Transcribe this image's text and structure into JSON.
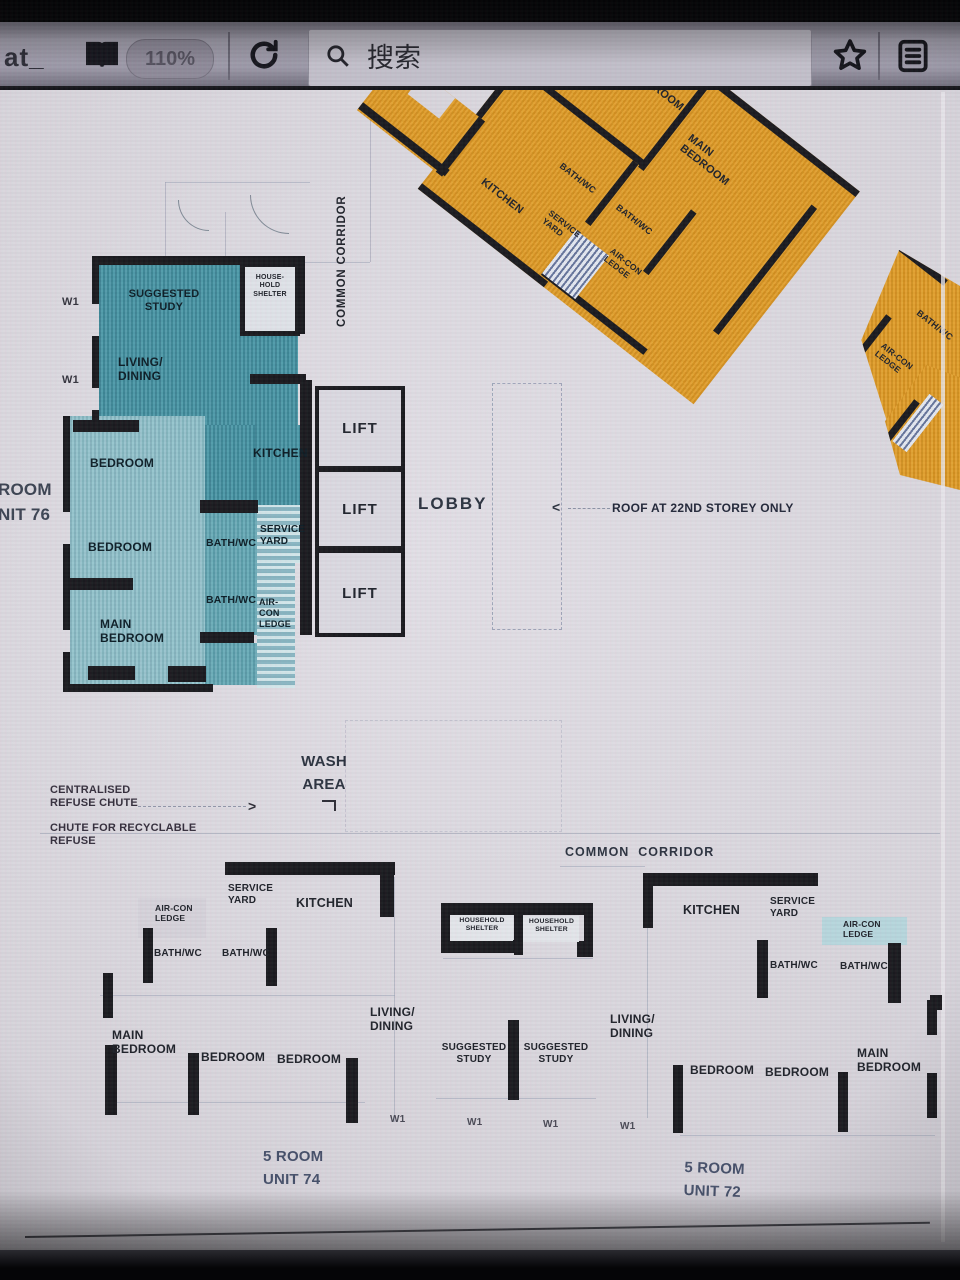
{
  "browser": {
    "url_fragment": "at_",
    "zoom_level": "110%",
    "search_placeholder": "搜索"
  },
  "plan": {
    "labels": {
      "lift": "LIFT",
      "lobby": "LOBBY",
      "roof_note": "ROOF AT 22ND STOREY ONLY",
      "common_corridor_v": "COMMON CORRIDOR",
      "common_corridor_h": "COMMON  CORRIDOR",
      "wash_area": "WASH\nAREA",
      "centralised_refuse_chute": "CENTRALISED\nREFUSE CHUTE",
      "chute_recyclable": "CHUTE FOR RECYCLABLE\nREFUSE",
      "w1": "W1",
      "unit76_edge": "ROOM\nNIT 76"
    },
    "unit_top_right": {
      "bedroom": "BEDROOM",
      "main_bedroom": "MAIN\nBEDROOM",
      "kitchen": "KITCHEN",
      "bath_wc": "BATH/WC",
      "bath_wc2": "BATH/WC",
      "service_yard": "SERVICE\nYARD",
      "aircon_ledge": "AIR-CON\nLEDGE"
    },
    "unit_right_edge": {
      "bath_wc": "BATH/WC",
      "aircon_ledge": "AIR-CON\nLEDGE"
    },
    "unit76": {
      "suggested_study": "SUGGESTED\nSTUDY",
      "household_shelter": "HOUSE-\nHOLD\nSHELTER",
      "living_dining": "LIVING/\nDINING",
      "bedroom_1": "BEDROOM",
      "bedroom_2": "BEDROOM",
      "kitchen": "KITCHEN",
      "bath_wc_1": "BATH/WC",
      "service_yard": "SERVICE\nYARD",
      "bath_wc_2": "BATH/WC",
      "aircon_ledge": "AIR-\nCON\nLEDGE",
      "main_bedroom": "MAIN\nBEDROOM"
    },
    "unit74": {
      "name": "5 ROOM\nUNIT 74",
      "aircon_ledge": "AIR-CON\nLEDGE",
      "service_yard": "SERVICE\nYARD",
      "kitchen": "KITCHEN",
      "bath_wc_1": "BATH/WC",
      "bath_wc_2": "BATH/WC",
      "main_bedroom": "MAIN\nBEDROOM",
      "bedroom_1": "BEDROOM",
      "bedroom_2": "BEDROOM",
      "living_dining": "LIVING/\nDINING",
      "suggested_study": "SUGGESTED\nSTUDY"
    },
    "shelter_center": {
      "household_shelter_1": "HOUSEHOLD\nSHELTER",
      "household_shelter_2": "HOUSEHOLD\nSHELTER"
    },
    "unit72": {
      "name": "5 ROOM\nUNIT 72",
      "kitchen": "KITCHEN",
      "service_yard": "SERVICE\nYARD",
      "aircon_ledge": "AIR-CON\nLEDGE",
      "bath_wc_1": "BATH/WC",
      "bath_wc_2": "BATH/WC",
      "living_dining": "LIVING/\nDINING",
      "suggested_study": "SUGGESTED\nSTUDY",
      "bedroom_1": "BEDROOM",
      "bedroom_2": "BEDROOM",
      "main_bedroom": "MAIN\nBEDROOM"
    },
    "colors": {
      "teal": "#4796a6",
      "orange": "#df9a26",
      "wall": "#1b1b20"
    }
  }
}
